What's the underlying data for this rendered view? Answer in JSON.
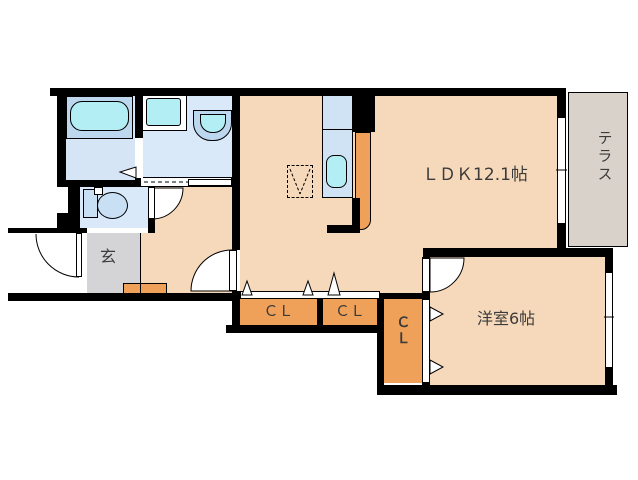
{
  "labels": {
    "ldk": "ＬＤＫ12.1帖",
    "western_room": "洋室6帖",
    "terrace": "テラス",
    "entrance": "玄",
    "closet_a": "ＣＬ",
    "closet_b": "ＣＬ",
    "closet_c": "ＣＬ"
  },
  "colors": {
    "wall": "#000000",
    "floor-beige": "#f6d9bb",
    "entrance-gray": "#d4d4d6",
    "terrace-gray": "#d9d2ca",
    "closet-orange": "#f0a159",
    "wet-floor-blue": "#d9e9fa",
    "bath-floor-blue": "#d5e5f6",
    "fixture-blue": "#bdd7ef",
    "fixture-inner-blue": "#c9e0f4",
    "water-cyan": "#b2eef3",
    "kitchen-blue": "#cfe3f5",
    "text": "#3b3b3b"
  },
  "icons": {
    "bathtub-icon": "rounded-rect",
    "toilet-icon": "tank-and-bowl",
    "washbasin-icon": "half-round-bowl",
    "washing-machine-icon": "square-pan",
    "kitchen-sink-icon": "rounded-rect",
    "refrigerator-space-icon": "dashed-box-v",
    "door-swing-icon": "quarter-arc",
    "sliding-door-icon": "dashed-track",
    "closet-door-icon": "triangle-marker"
  }
}
